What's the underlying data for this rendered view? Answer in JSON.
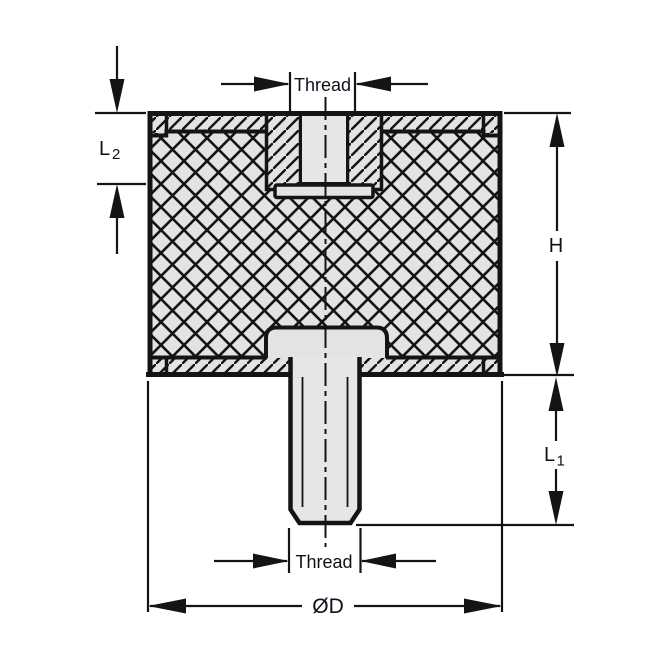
{
  "drawing": {
    "type": "technical-cross-section",
    "subject": "rubber-buffer-vibration-mount",
    "labels": {
      "thread_top": "Thread",
      "thread_bottom": "Thread",
      "height": "H",
      "diameter": "ØD",
      "l2_base": "L",
      "l2_sub": "2",
      "l1_base": "L",
      "l1_sub": "1"
    },
    "colors": {
      "line": "#141414",
      "text": "#10101a",
      "part_fill": "#e3e3e3",
      "bore_fill": "#e6e6e6",
      "background": "#ffffff"
    }
  }
}
